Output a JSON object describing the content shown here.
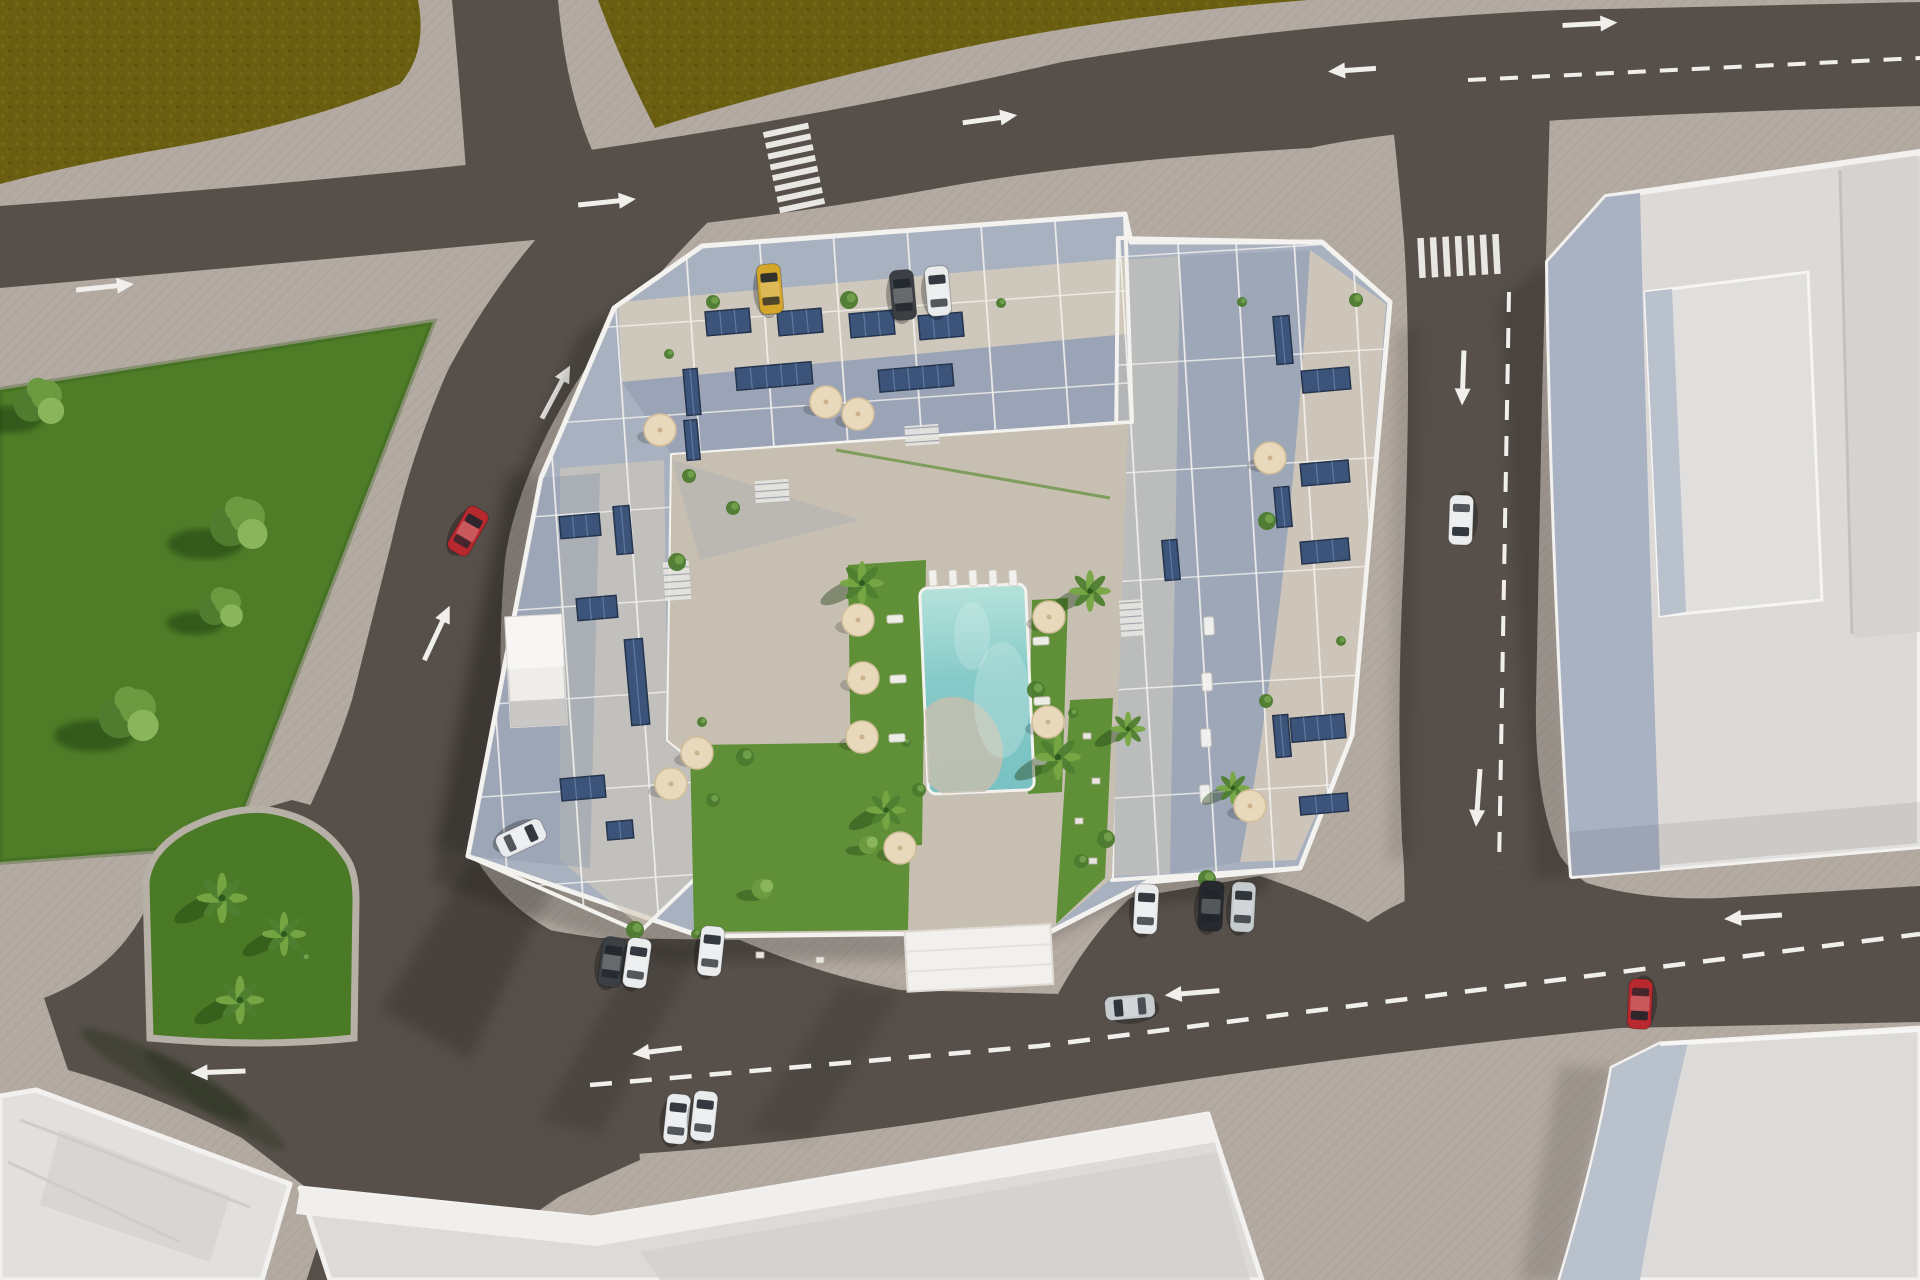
{
  "meta": {
    "description": "Aerial top-down 3D architectural render of a residential apartment complex with rooftop terraces, solar panels, a central courtyard swimming pool and gardens, surrounded by roads with white lane markings, crosswalks, cars, a green park with trees and a palm-planted traffic island, and neighbouring flat-roofed buildings."
  },
  "colors": {
    "sidewalk": "#b3aaa1",
    "sidewalkShade": "#978e85",
    "asphalt": "#57504a",
    "asphaltDark": "#49423d",
    "field": "#6a5e11",
    "fieldDot": "#7b6e1c",
    "fieldDot2": "#564a0c",
    "park": "#4e7c27",
    "parkShade": "#3a611c",
    "island": "#4a7a26",
    "treeDark": "#4f7c2e",
    "treeMid": "#6b9a41",
    "treeLight": "#8ab55b",
    "palmDark": "#4e8030",
    "palmLight": "#77a843",
    "lawn": "#5f8f37",
    "poolTop": "#b5e2da",
    "poolMid": "#86cac9",
    "poolDeep": "#79c1c3",
    "poolBeach": "#c6bfae",
    "terrace": "#a8b1c0",
    "terraceSun": "#d3c9b9",
    "plaza": "#c6bfb2",
    "wallWhite": "#f3f2ee",
    "solar": "#3c5479",
    "solarLine": "#6783ab",
    "solarEdge": "#24344d",
    "umbrella": "#e8d9bc",
    "umbrellaEdge": "#d2bd98",
    "marking": "#f0efec",
    "roofWarm": "#dcd9d7",
    "bldgWest": "#a9b2c2",
    "bldgTrim": "#f2f1ef",
    "bldgRaised": "#e1dfdd",
    "bldgRaisedWest": "#b9c1cd",
    "roofB": "#dddbd9",
    "roofC": "#d2d0cd",
    "roofLight": "#e2e0de",
    "carRed": "#b8292f",
    "carYellow": "#d4a62a",
    "carWhite": "#e9ebec",
    "carSilver": "#c6cbcd",
    "carDark": "#3c4045",
    "carBlack": "#26292d"
  },
  "scene": {
    "cars": [
      {
        "name": "red-car-left-road",
        "color": "carRed",
        "x": 468,
        "y": 531,
        "rot": 30
      },
      {
        "name": "yellow-car-top-parking",
        "color": "carYellow",
        "x": 770,
        "y": 289,
        "rot": -5
      },
      {
        "name": "dark-car-top-parking",
        "color": "carDark",
        "x": 903,
        "y": 295,
        "rot": -5
      },
      {
        "name": "white-car-top-parking",
        "color": "carWhite",
        "x": 938,
        "y": 291,
        "rot": -5
      },
      {
        "name": "white-car-right-road",
        "color": "carWhite",
        "x": 1461,
        "y": 520,
        "rot": 182
      },
      {
        "name": "silver-car-bottom-road",
        "color": "carSilver",
        "x": 1130,
        "y": 1007,
        "rot": 265
      },
      {
        "name": "red-car-bottom-road",
        "color": "carRed",
        "x": 1640,
        "y": 1004,
        "rot": 183
      },
      {
        "name": "white-car-parked-sw-1",
        "color": "carWhite",
        "x": 677,
        "y": 1119,
        "rot": 6
      },
      {
        "name": "white-car-parked-sw-2",
        "color": "carWhite",
        "x": 704,
        "y": 1116,
        "rot": 6
      },
      {
        "name": "dark-car-parked-south",
        "color": "carDark",
        "x": 612,
        "y": 962,
        "rot": 8
      },
      {
        "name": "white-car-parked-south-1",
        "color": "carWhite",
        "x": 637,
        "y": 963,
        "rot": 8
      },
      {
        "name": "white-car-parked-south-2",
        "color": "carWhite",
        "x": 711,
        "y": 951,
        "rot": 6
      },
      {
        "name": "white-car-parked-se",
        "color": "carWhite",
        "x": 1146,
        "y": 909,
        "rot": 3
      },
      {
        "name": "black-car-parked-se",
        "color": "carBlack",
        "x": 1211,
        "y": 906,
        "rot": 3
      },
      {
        "name": "silver-car-parked-se",
        "color": "carSilver",
        "x": 1243,
        "y": 907,
        "rot": 3
      },
      {
        "name": "white-car-complex-west",
        "color": "carWhite",
        "x": 521,
        "y": 838,
        "rot": 65
      }
    ],
    "arrows": [
      {
        "x": 105,
        "y": 287,
        "rot": 84,
        "len": 58
      },
      {
        "x": 607,
        "y": 202,
        "rot": 84,
        "len": 58
      },
      {
        "x": 990,
        "y": 119,
        "rot": 82,
        "len": 55
      },
      {
        "x": 1590,
        "y": 24,
        "rot": 87,
        "len": 55
      },
      {
        "x": 1352,
        "y": 70,
        "rot": 266,
        "len": 48
      },
      {
        "x": 556,
        "y": 392,
        "rot": 28,
        "len": 60
      },
      {
        "x": 437,
        "y": 633,
        "rot": 25,
        "len": 60
      },
      {
        "x": 1463,
        "y": 378,
        "rot": 182,
        "len": 55
      },
      {
        "x": 1478,
        "y": 798,
        "rot": 184,
        "len": 58
      },
      {
        "x": 1192,
        "y": 993,
        "rot": 265,
        "len": 55
      },
      {
        "x": 657,
        "y": 1051,
        "rot": 263,
        "len": 50
      },
      {
        "x": 218,
        "y": 1072,
        "rot": 268,
        "len": 55
      },
      {
        "x": 1753,
        "y": 917,
        "rot": 266,
        "len": 58
      }
    ],
    "crosswalks": [
      {
        "x": 794,
        "y": 168,
        "rot": -12,
        "bars": 8,
        "len": 46,
        "th": 6,
        "gap": 5
      },
      {
        "x": 1459,
        "y": 256,
        "rot": 87,
        "bars": 7,
        "len": 40,
        "th": 6.5,
        "gap": 6
      },
      {
        "x": 387,
        "y": 1228,
        "rot": 100,
        "bars": 6,
        "len": 44,
        "th": 6,
        "gap": 5
      }
    ],
    "solarPanels": [
      [
        728,
        322,
        44,
        24
      ],
      [
        800,
        322,
        44,
        24
      ],
      [
        872,
        324,
        44,
        24
      ],
      [
        941,
        326,
        44,
        24
      ],
      [
        774,
        376,
        76,
        22
      ],
      [
        916,
        378,
        74,
        22
      ],
      [
        692,
        392,
        14,
        46
      ],
      [
        692,
        440,
        13,
        40
      ],
      [
        580,
        526,
        40,
        22
      ],
      [
        623,
        530,
        16,
        48
      ],
      [
        597,
        608,
        40,
        22
      ],
      [
        637,
        682,
        18,
        86
      ],
      [
        583,
        788,
        44,
        22
      ],
      [
        620,
        830,
        26,
        18
      ],
      [
        1283,
        340,
        16,
        48
      ],
      [
        1326,
        380,
        48,
        22
      ],
      [
        1283,
        507,
        15,
        40
      ],
      [
        1325,
        473,
        48,
        22
      ],
      [
        1325,
        551,
        48,
        22
      ],
      [
        1282,
        736,
        15,
        42
      ],
      [
        1318,
        728,
        54,
        24
      ],
      [
        1324,
        804,
        48,
        18
      ],
      [
        1171,
        560,
        15,
        40
      ]
    ],
    "umbrellas": [
      [
        660,
        430
      ],
      [
        826,
        402
      ],
      [
        858,
        414
      ],
      [
        697,
        753
      ],
      [
        671,
        784
      ],
      [
        858,
        620
      ],
      [
        863,
        678
      ],
      [
        862,
        737
      ],
      [
        1049,
        617
      ],
      [
        1048,
        722
      ],
      [
        900,
        848
      ],
      [
        1270,
        458
      ],
      [
        1250,
        806
      ]
    ],
    "palms": [
      [
        862,
        583,
        1
      ],
      [
        1090,
        591,
        0.95
      ],
      [
        1058,
        757,
        1.05
      ],
      [
        886,
        810,
        0.9
      ],
      [
        1128,
        729,
        0.8
      ],
      [
        1233,
        788,
        0.75
      ]
    ],
    "islandPalms": [
      [
        222,
        898,
        1.15
      ],
      [
        284,
        934,
        1.0
      ],
      [
        240,
        1000,
        1.1
      ]
    ],
    "parkTrees": [
      [
        40,
        402,
        1.1
      ],
      [
        240,
        524,
        1.25
      ],
      [
        222,
        608,
        0.95
      ],
      [
        130,
        715,
        1.3
      ]
    ],
    "leafTrees": [
      [
        762,
        889,
        0.8
      ],
      [
        868,
        845,
        0.7
      ]
    ],
    "shrubs": [
      [
        669,
        354
      ],
      [
        713,
        302
      ],
      [
        849,
        300
      ],
      [
        1001,
        303
      ],
      [
        689,
        476
      ],
      [
        677,
        562
      ],
      [
        702,
        722
      ],
      [
        713,
        800
      ],
      [
        745,
        757
      ],
      [
        906,
        742
      ],
      [
        919,
        790
      ],
      [
        1036,
        690
      ],
      [
        1073,
        713
      ],
      [
        1081,
        861
      ],
      [
        1106,
        839
      ],
      [
        1242,
        302
      ],
      [
        1356,
        300
      ],
      [
        1267,
        521
      ],
      [
        1341,
        641
      ],
      [
        1266,
        701
      ],
      [
        1207,
        879
      ],
      [
        696,
        934
      ],
      [
        733,
        508
      ],
      [
        635,
        930
      ],
      [
        305,
        958
      ]
    ],
    "loungers": [
      [
        933,
        578,
        8,
        16
      ],
      [
        953,
        578,
        8,
        16
      ],
      [
        973,
        578,
        8,
        16
      ],
      [
        993,
        578,
        8,
        16
      ],
      [
        1013,
        578,
        8,
        16
      ],
      [
        895,
        619,
        16,
        8
      ],
      [
        898,
        679,
        16,
        8
      ],
      [
        897,
        738,
        16,
        8
      ],
      [
        1041,
        641,
        16,
        8
      ],
      [
        1042,
        701,
        16,
        8
      ],
      [
        1041,
        761,
        16,
        8
      ],
      [
        1209,
        626,
        10,
        18
      ],
      [
        1207,
        682,
        10,
        18
      ],
      [
        1206,
        738,
        10,
        18
      ],
      [
        1205,
        794,
        10,
        18
      ]
    ],
    "bits": [
      [
        1087,
        736
      ],
      [
        1096,
        781
      ],
      [
        1079,
        821
      ],
      [
        1093,
        861
      ],
      [
        760,
        955
      ],
      [
        820,
        960
      ]
    ]
  }
}
